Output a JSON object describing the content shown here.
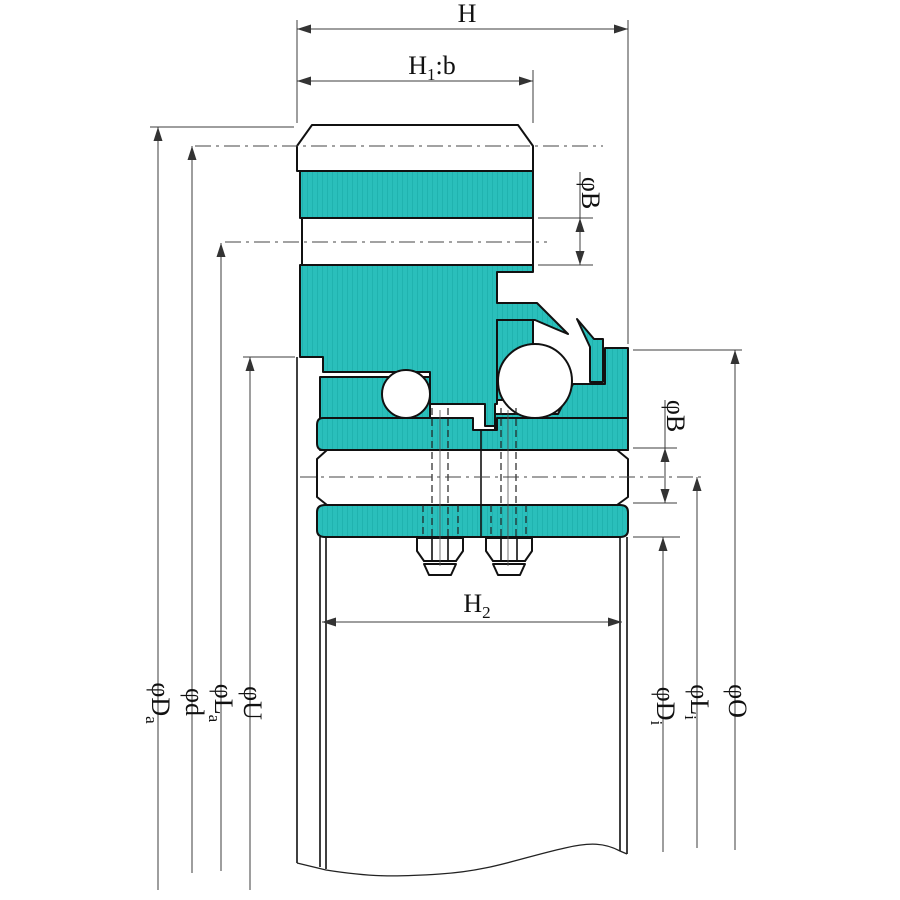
{
  "drawing": {
    "type": "bearing-cross-section",
    "description": "Slewing ring bearing sectional drawing with gear flange, two ball rows, labyrinth seal, clamping bolts and diameter/height dimension callouts"
  },
  "colors": {
    "part_fill": "#2ABFBB",
    "part_hatch": "#14A3A0",
    "outline": "#111111",
    "dimension_line": "#3C3C3C",
    "background": "#FFFFFF"
  },
  "labels": {
    "h": {
      "pre": "H"
    },
    "h1b": {
      "pre": "H",
      "sub": "1",
      "post": ":b"
    },
    "h2": {
      "pre": "H",
      "sub": "2"
    },
    "phi_b_top": {
      "pre": "φB"
    },
    "phi_b_bottom": {
      "pre": "φB"
    },
    "phi_d_a": {
      "pre": "φD",
      "sub": "a"
    },
    "phi_d": {
      "pre": "φd"
    },
    "phi_l_a": {
      "pre": "φL",
      "sub": "a"
    },
    "phi_u": {
      "pre": "φU"
    },
    "phi_d_i": {
      "pre": "φD",
      "sub": "i"
    },
    "phi_l_i": {
      "pre": "φL",
      "sub": "i"
    },
    "phi_o": {
      "pre": "φO"
    }
  }
}
